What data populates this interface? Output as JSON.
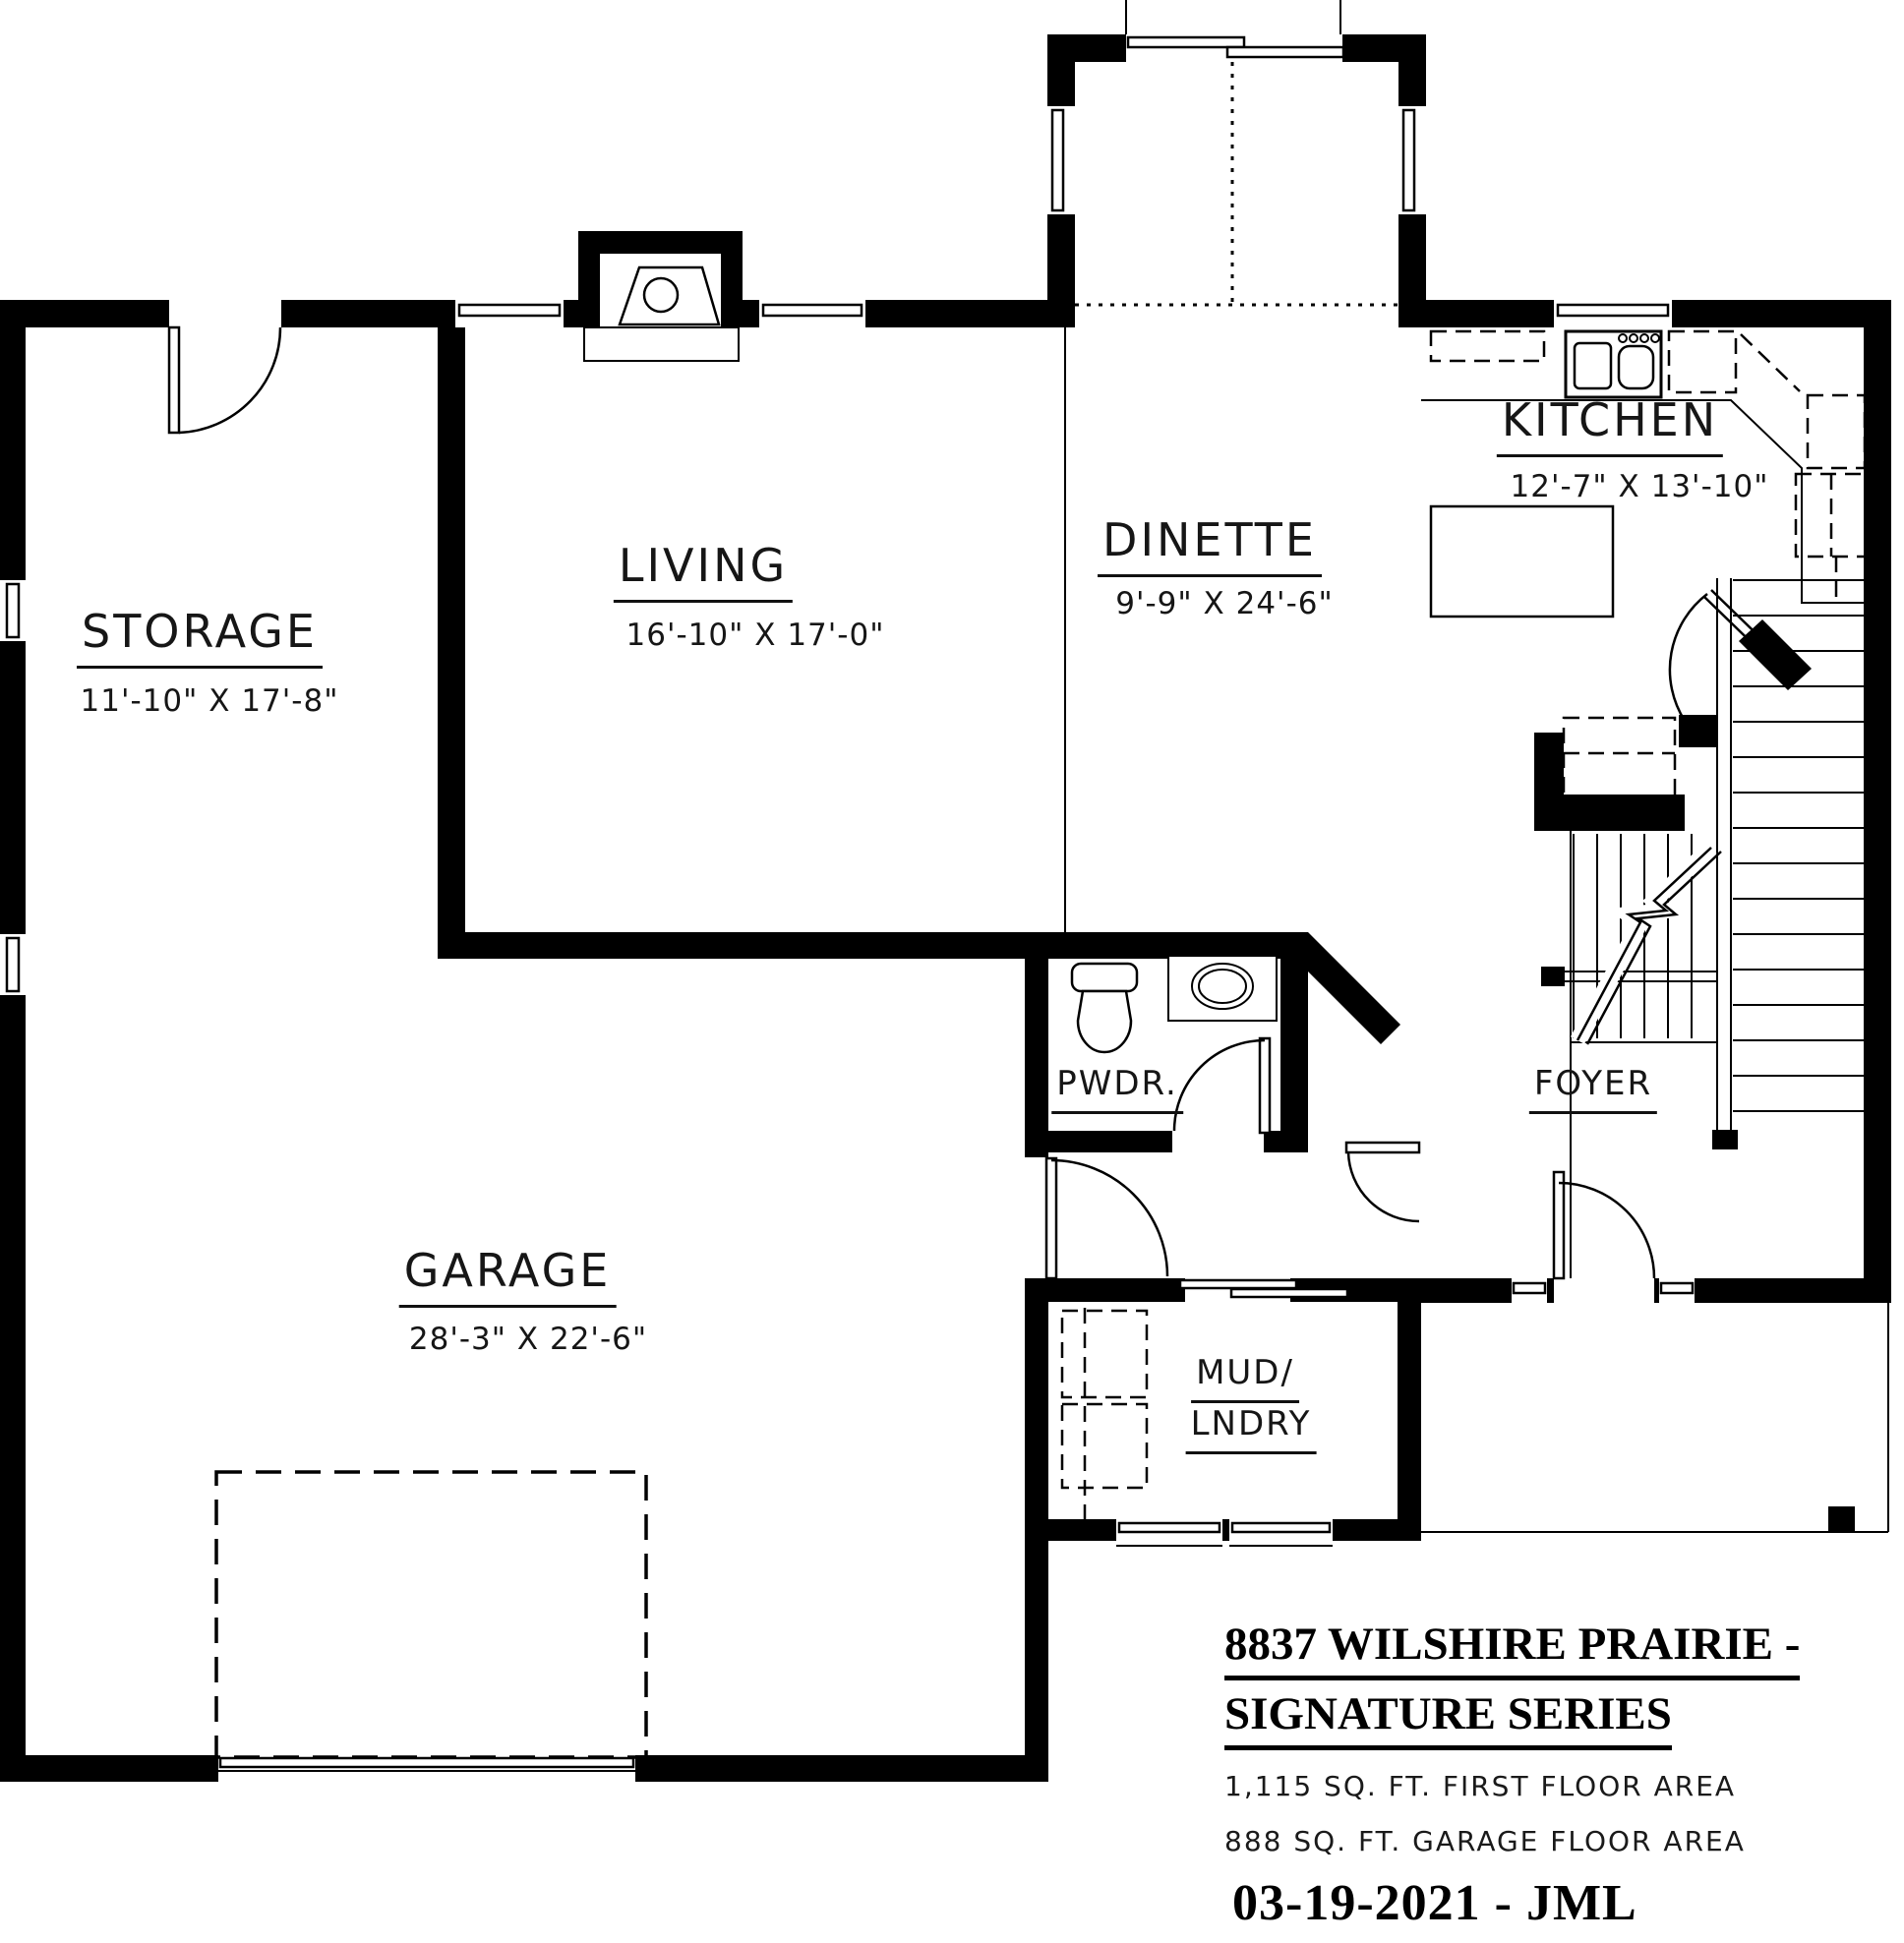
{
  "rooms": {
    "storage": {
      "label": "STORAGE",
      "dims": "11'-10\" X 17'-8\""
    },
    "living": {
      "label": "LIVING",
      "dims": "16'-10\" X 17'-0\""
    },
    "dinette": {
      "label": "DINETTE",
      "dims": "9'-9\" X 24'-6\""
    },
    "kitchen": {
      "label": "KITCHEN",
      "dims": "12'-7\" X 13'-10\""
    },
    "garage": {
      "label": "GARAGE",
      "dims": "28'-3\" X 22'-6\""
    },
    "powder": {
      "label": "PWDR."
    },
    "foyer": {
      "label": "FOYER"
    },
    "mud_laundry": {
      "label_line1": "MUD/",
      "label_line2": "LNDRY"
    }
  },
  "title_block": {
    "address_line1": "8837 WILSHIRE PRAIRIE -",
    "address_line2": "SIGNATURE SERIES",
    "first_floor_area": "1,115 SQ. FT. FIRST FLOOR AREA",
    "garage_floor_area": "888 SQ. FT. GARAGE FLOOR AREA",
    "date_author": "03-19-2021 - JML"
  },
  "colors": {
    "ink": "#000000",
    "paper": "#ffffff"
  }
}
